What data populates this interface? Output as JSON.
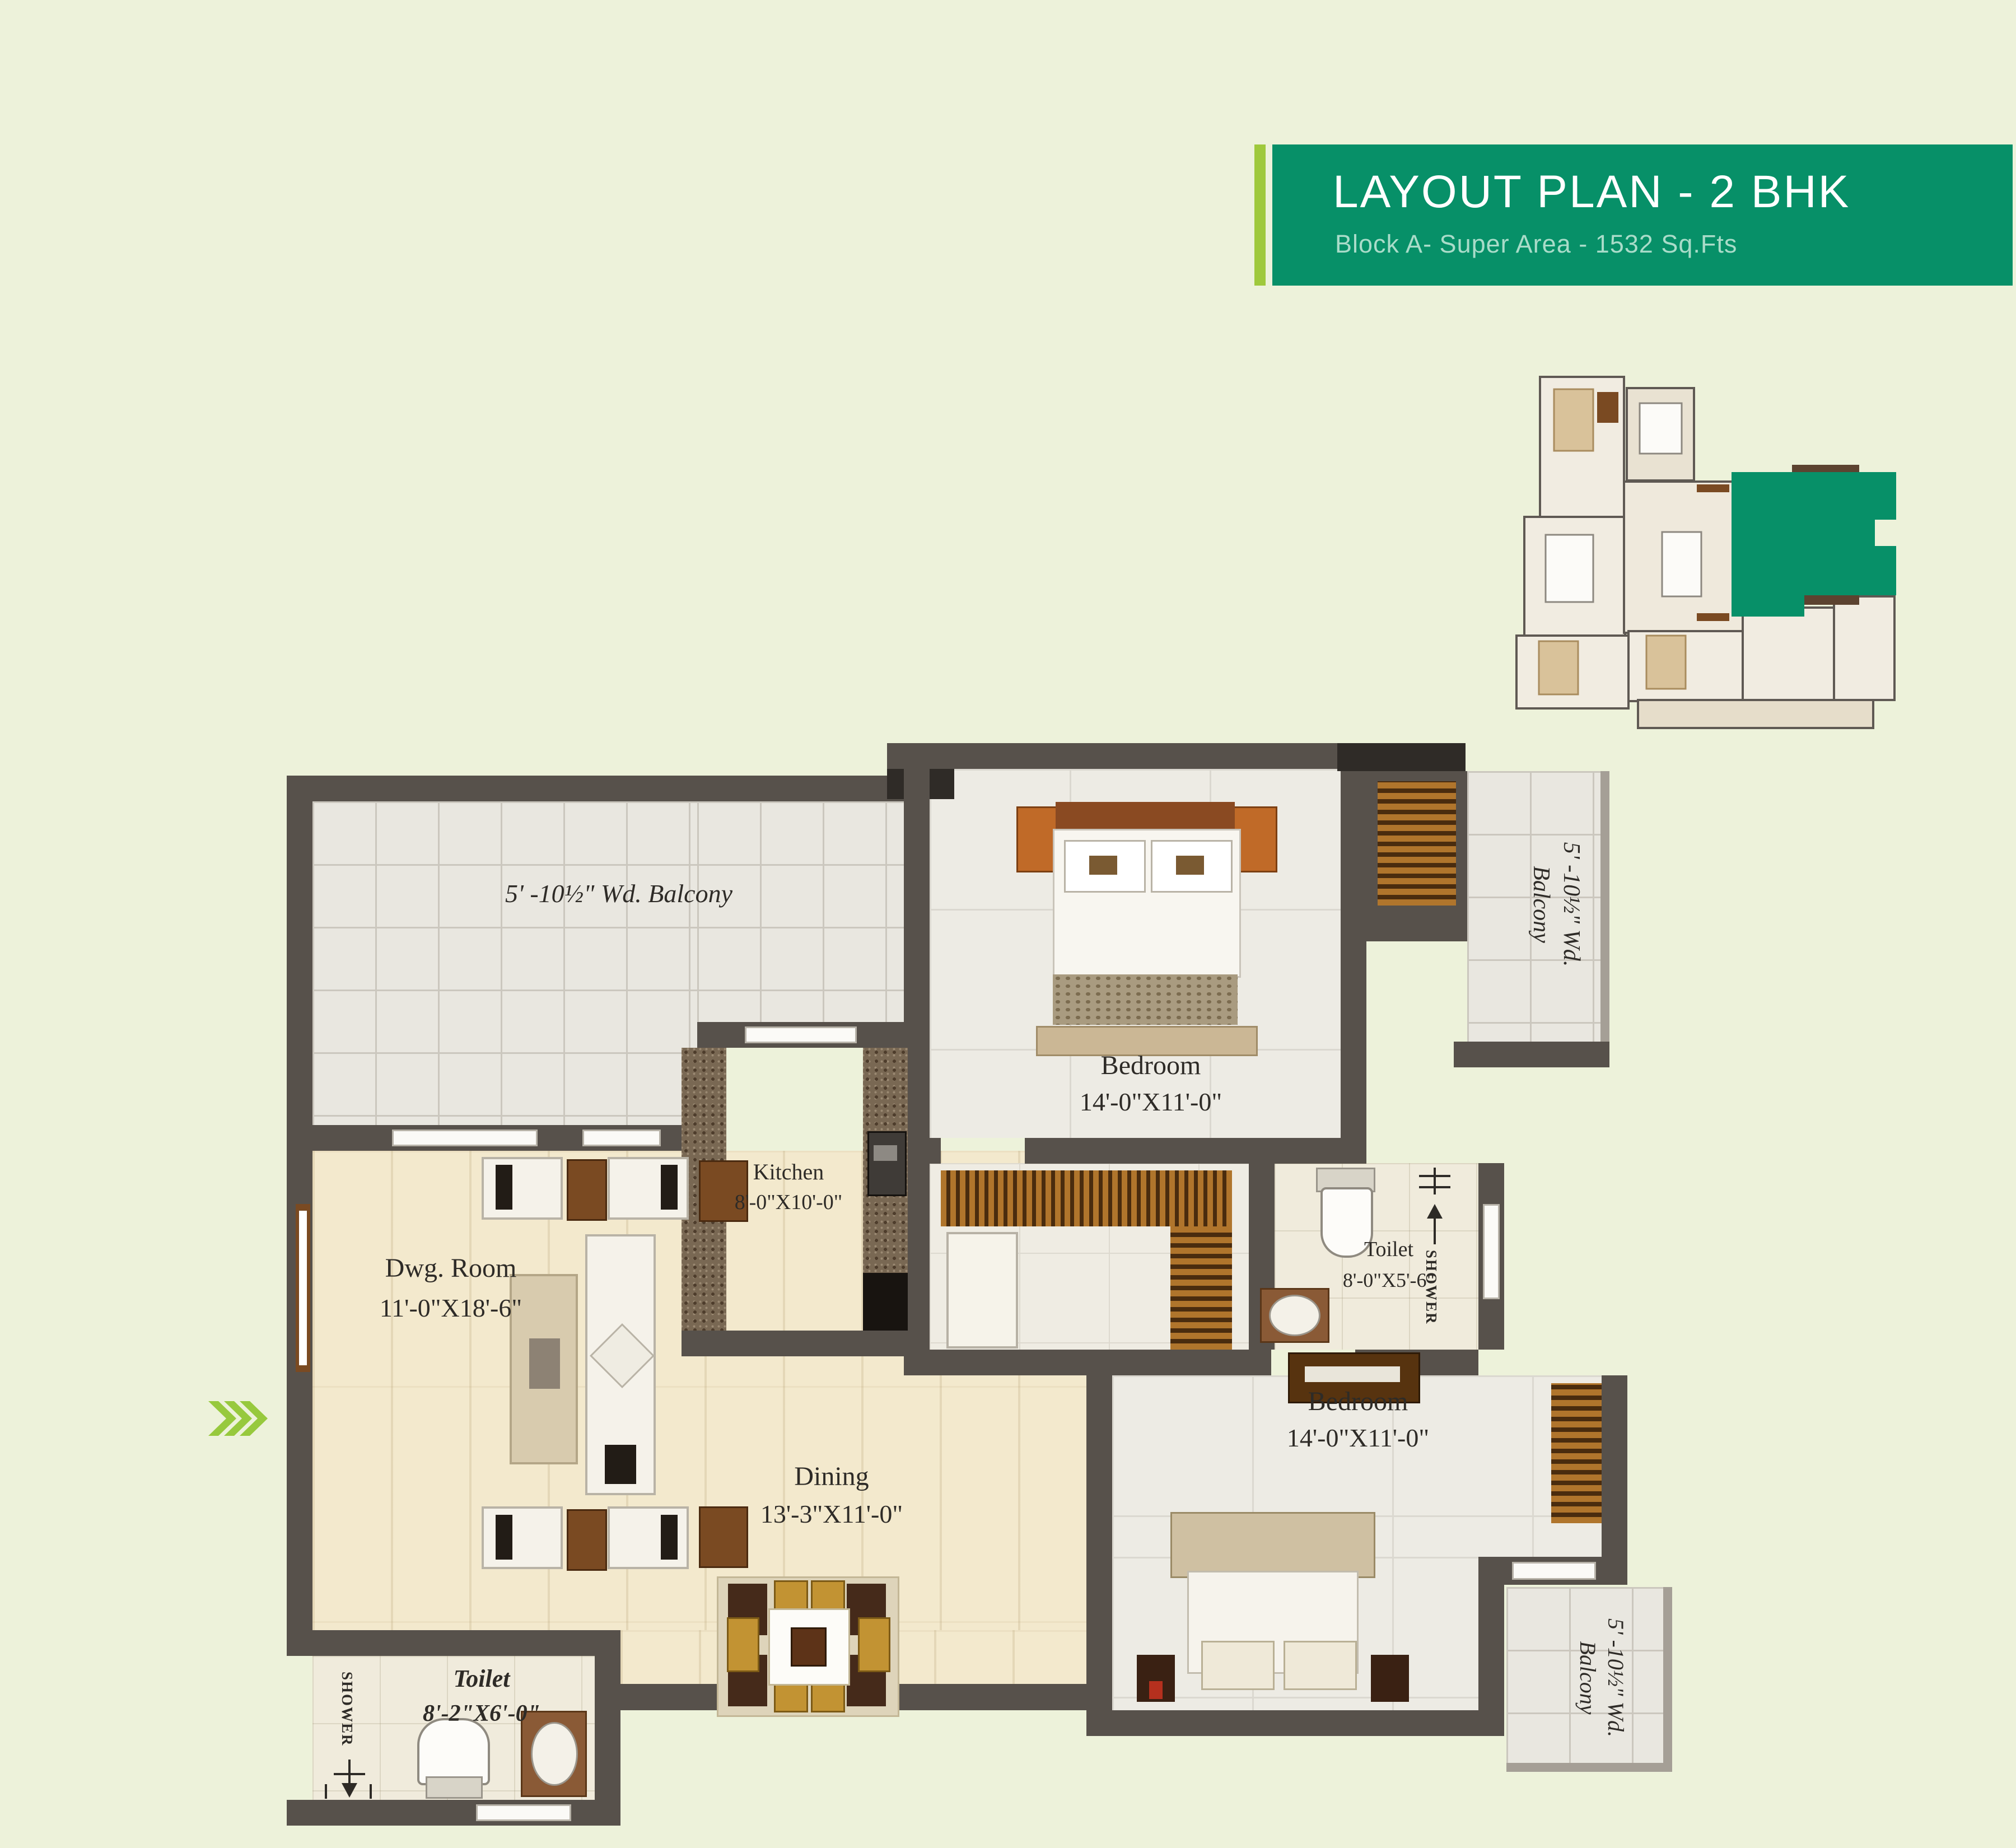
{
  "header": {
    "title": "LAYOUT PLAN - 2 BHK",
    "subtitle": "Block A- Super Area - 1532 Sq.Fts",
    "teal": "#079068",
    "lime": "#9fc93c"
  },
  "key_plan": {
    "highlight_color": "#079068"
  },
  "plan": {
    "balcony_top": {
      "label": "5' -10½\" Wd. Balcony"
    },
    "balcony_right": {
      "line1": "5' -10½\" Wd.",
      "line2": "Balcony"
    },
    "balcony_bottom": {
      "line1": "5' -10½\" Wd.",
      "line2": "Balcony"
    },
    "bedroom1": {
      "name": "Bedroom",
      "dims": "14'-0\"X11'-0\""
    },
    "bedroom2": {
      "name": "Bedroom",
      "dims": "14'-0\"X11'-0\""
    },
    "dwg_room": {
      "name": "Dwg. Room",
      "dims": "11'-0\"X18'-6\""
    },
    "kitchen": {
      "name": "Kitchen",
      "dims": "8'-0\"X10'-0\""
    },
    "dining": {
      "name": "Dining",
      "dims": "13'-3\"X11'-0\""
    },
    "toilet1": {
      "name": "Toilet",
      "dims": "8'-0\"X5'-6\"",
      "shower": "SHOWER"
    },
    "toilet2": {
      "name": "Toilet",
      "dims": "8'-2\"X6'-0\"",
      "shower": "SHOWER"
    }
  },
  "colors": {
    "wall": "#57514b",
    "page_bg": "#edf2da"
  }
}
